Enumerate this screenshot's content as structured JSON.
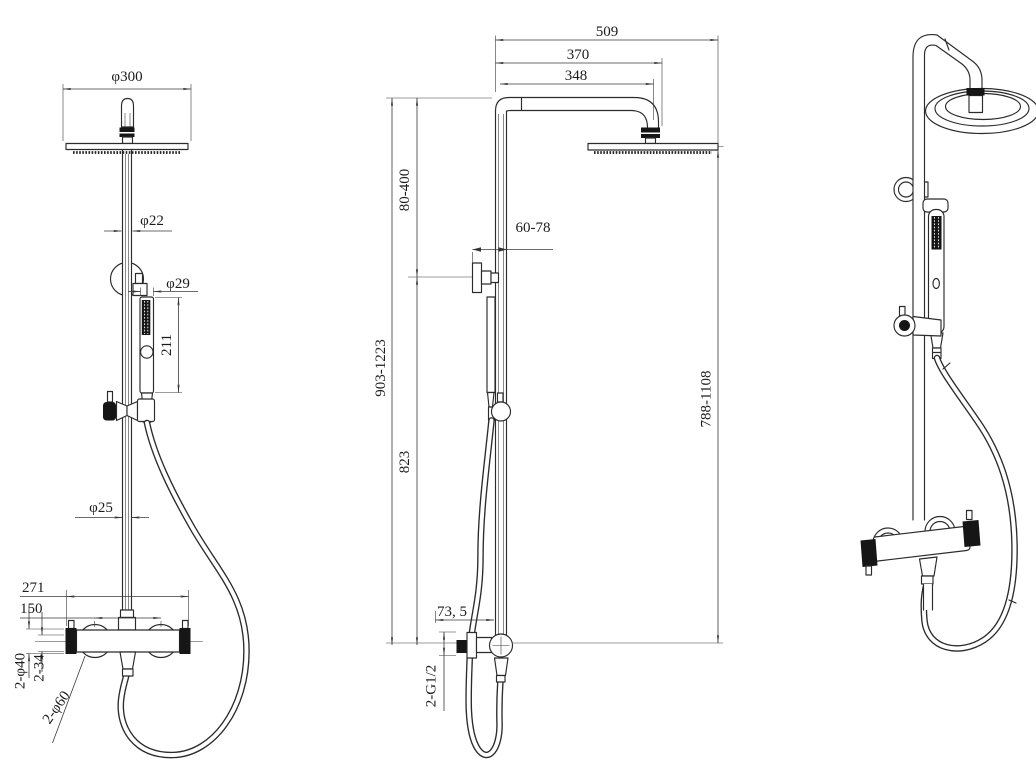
{
  "drawing": {
    "description": "Technical dimension drawing of a thermostatic shower column: front view, side view and perspective view",
    "colors": {
      "background": "#ffffff",
      "line": "#2b2b2b"
    }
  },
  "front": {
    "dims": {
      "head_diameter": "φ300",
      "riser_upper_diameter": "φ22",
      "handshower_head_diameter": "φ29",
      "handshower_length": "211",
      "riser_lower_diameter": "φ25",
      "valve_overall_width": "271",
      "inlet_spacing": "150",
      "end_caps_diameter": "2-φ40",
      "end_caps_width": "2-34",
      "escutcheons_diameter": "2-φ60"
    }
  },
  "side": {
    "dims": {
      "overall_depth": "509",
      "arm_outer_reach": "370",
      "arm_reach": "348",
      "upper_pipe_adjust": "80-400",
      "bracket_wall_clearance": "60-78",
      "overall_height": "903-1223",
      "lower_section_height": "823",
      "head_to_outlet_height": "788-1108",
      "outlet_offset": "73, 5",
      "inlet_threads": "2-G1/2"
    }
  }
}
